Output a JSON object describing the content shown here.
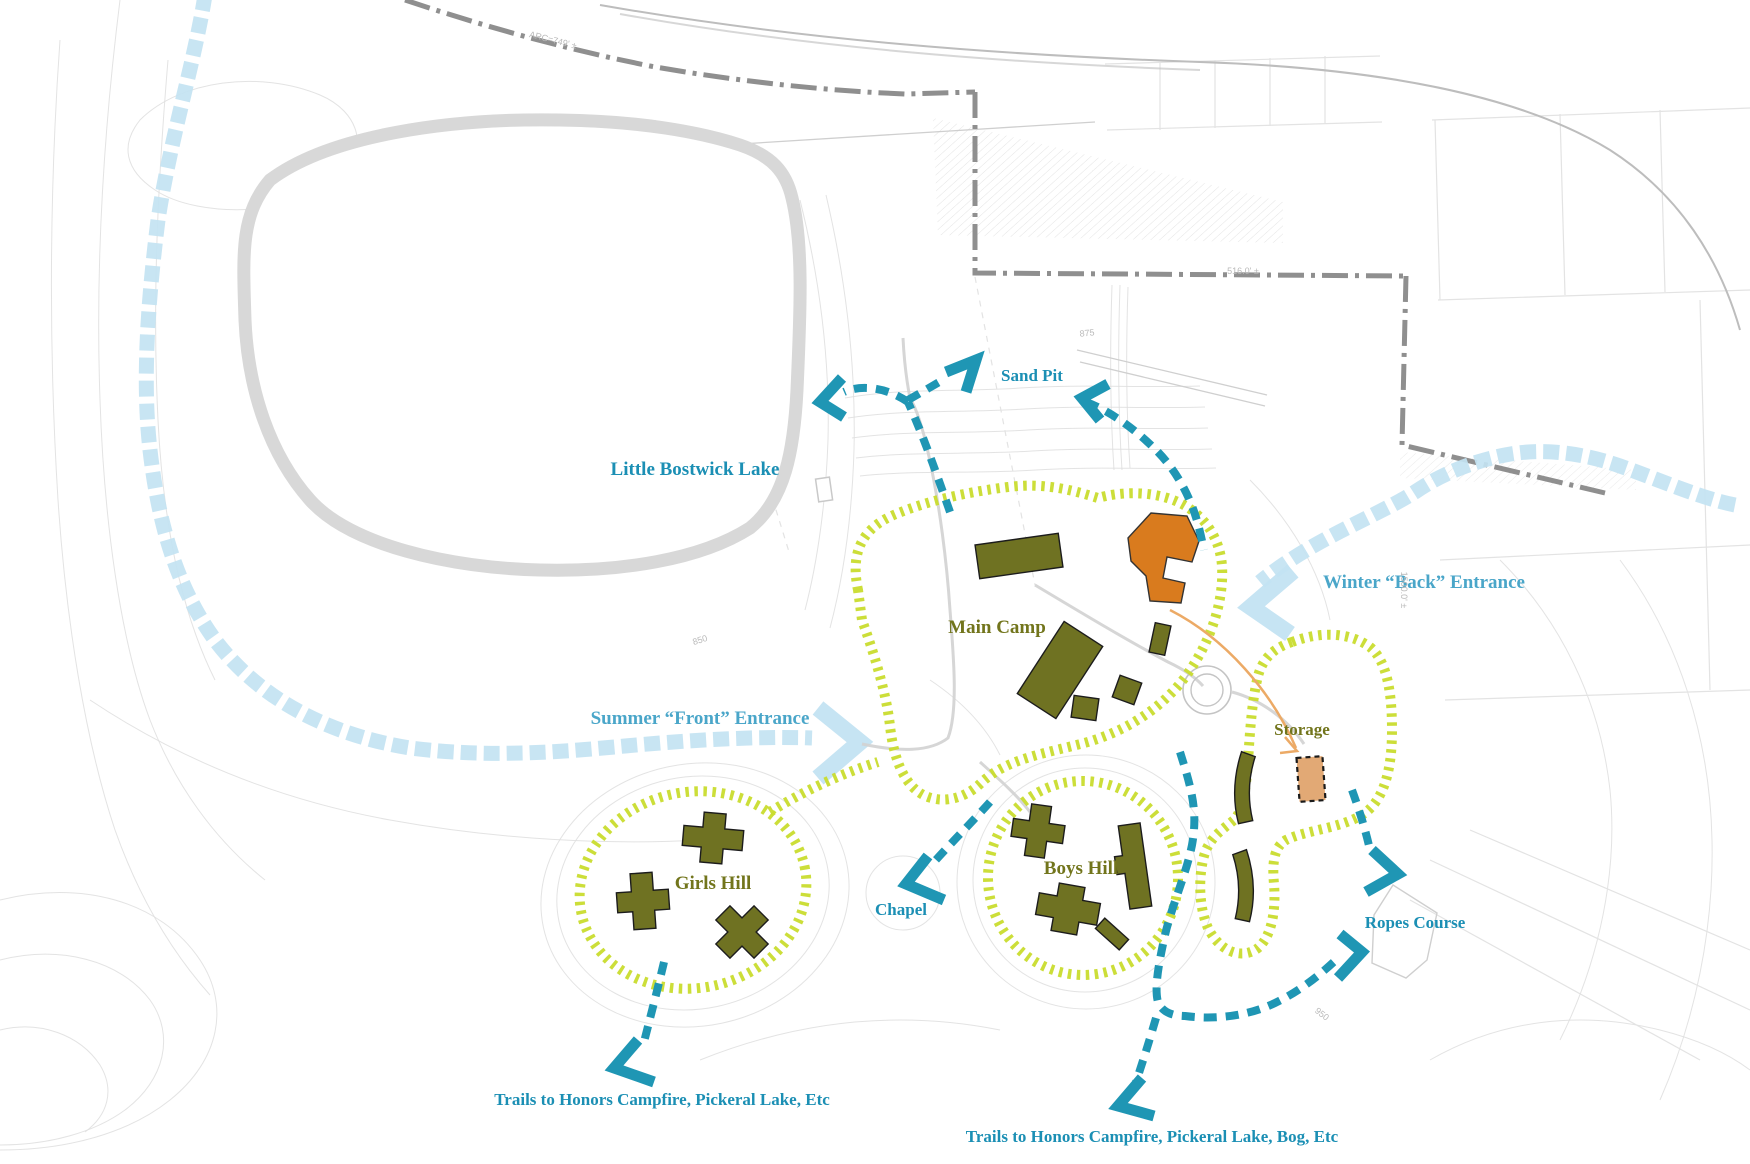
{
  "title": "Camp site plan",
  "labels": {
    "lake": "Little Bostwick Lake",
    "sand_pit": "Sand Pit",
    "summer_entrance": "Summer “Front” Entrance",
    "winter_entrance": "Winter “Back” Entrance",
    "main_camp": "Main Camp",
    "girls_hill": "Girls Hill",
    "boys_hill": "Boys Hill",
    "storage": "Storage",
    "chapel": "Chapel",
    "ropes_course": "Ropes Course",
    "trails_southwest": "Trails to Honors Campfire, Pickeral Lake, Etc",
    "trails_south": "Trails to Honors Campfire, Pickeral Lake, Bog, Etc"
  },
  "survey_annotations": {
    "arc_length": "ARC=749' ±",
    "boundary_516": "516.0' ±",
    "boundary_1500": "1500.0' ±",
    "elev_875": "875",
    "elev_850": "850",
    "elev_950": "950"
  },
  "colors": {
    "trail": "#1f96b4",
    "road": "#c3e3f2",
    "hatch": "#c9dc2e",
    "building": "#6f7222",
    "orange_building": "#d97b1e",
    "storage_tan": "#e2a975",
    "boundary": "#8f8f8f",
    "label_teal": "#1b8fb4",
    "label_blue": "#4aa6c9",
    "label_olive": "#72751c",
    "contour": "#dedede",
    "faint": "#e3e3e3"
  }
}
